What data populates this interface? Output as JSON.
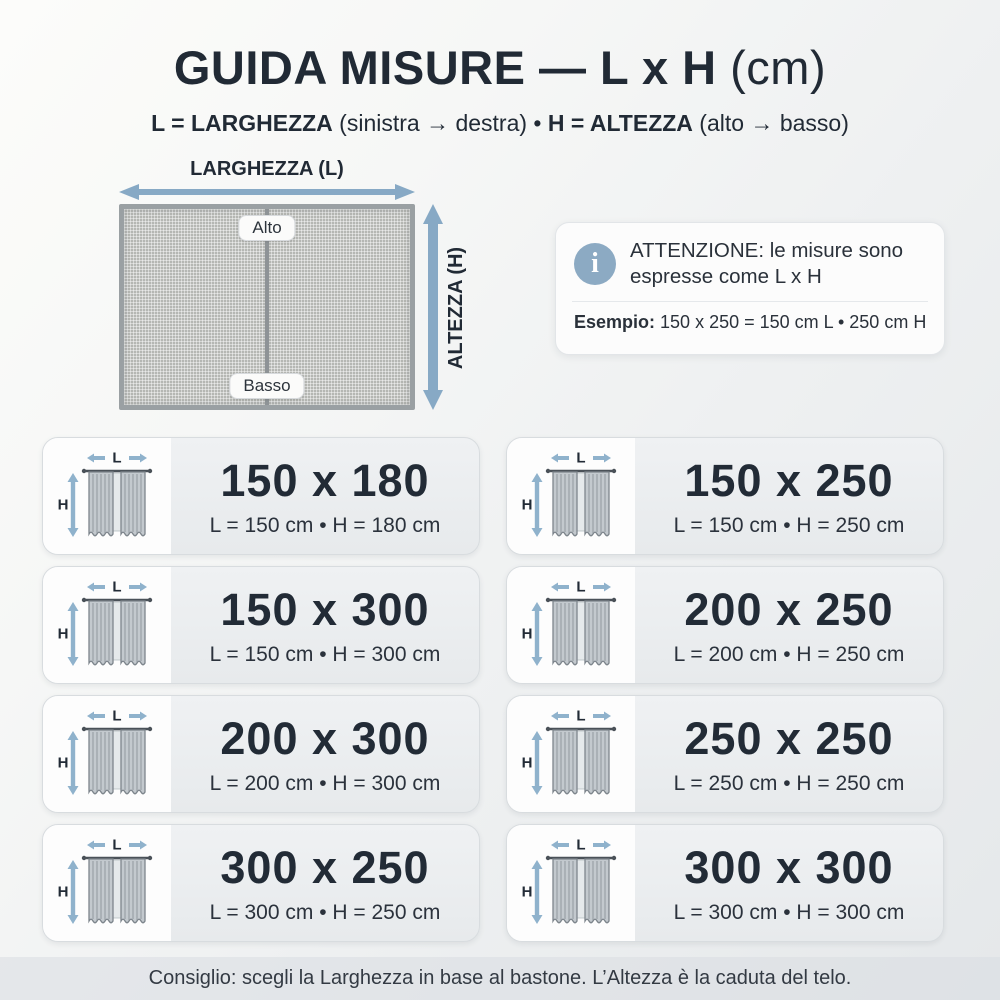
{
  "colors": {
    "accent_arrow": "#8fb2cc",
    "accent_arrow_big": "#87a9c5",
    "text_dark": "#222b36",
    "info_icon_bg": "#8caac3"
  },
  "header": {
    "title_main": "GUIDA MISURE — L x H ",
    "title_unit": "(cm)",
    "subtitle_l_term": "L = LARGHEZZA",
    "subtitle_l_range": " (sinistra → destra) • ",
    "subtitle_h_term": "H = ALTEZZA",
    "subtitle_h_range": " (alto → basso)"
  },
  "diagram": {
    "width_label": "LARGHEZZA (L)",
    "height_label": "ALTEZZA (H)",
    "top_badge": "Alto",
    "bottom_badge": "Basso"
  },
  "info_box": {
    "icon_glyph": "i",
    "message": "ATTENZIONE: le misure sono espresse come L x H",
    "example_label": "Esempio:",
    "example_value": " 150 x 250 = 150 cm L • 250 cm H"
  },
  "card_icon": {
    "l_label": "L",
    "h_label": "H"
  },
  "cards": [
    {
      "size": "150 x 180",
      "detail": "L = 150 cm • H = 180 cm"
    },
    {
      "size": "150 x 250",
      "detail": "L = 150 cm • H = 250 cm"
    },
    {
      "size": "150 x 300",
      "detail": "L = 150 cm • H = 300 cm"
    },
    {
      "size": "200 x 250",
      "detail": "L = 200 cm • H = 250 cm"
    },
    {
      "size": "200 x 300",
      "detail": "L = 200 cm • H = 300 cm"
    },
    {
      "size": "250 x 250",
      "detail": "L = 250 cm • H = 250 cm"
    },
    {
      "size": "300 x 250",
      "detail": "L = 300 cm • H = 250 cm"
    },
    {
      "size": "300 x 300",
      "detail": "L = 300 cm • H = 300 cm"
    }
  ],
  "footer": {
    "tip": "Consiglio: scegli la Larghezza in base al bastone. L’Altezza è la caduta del telo."
  }
}
